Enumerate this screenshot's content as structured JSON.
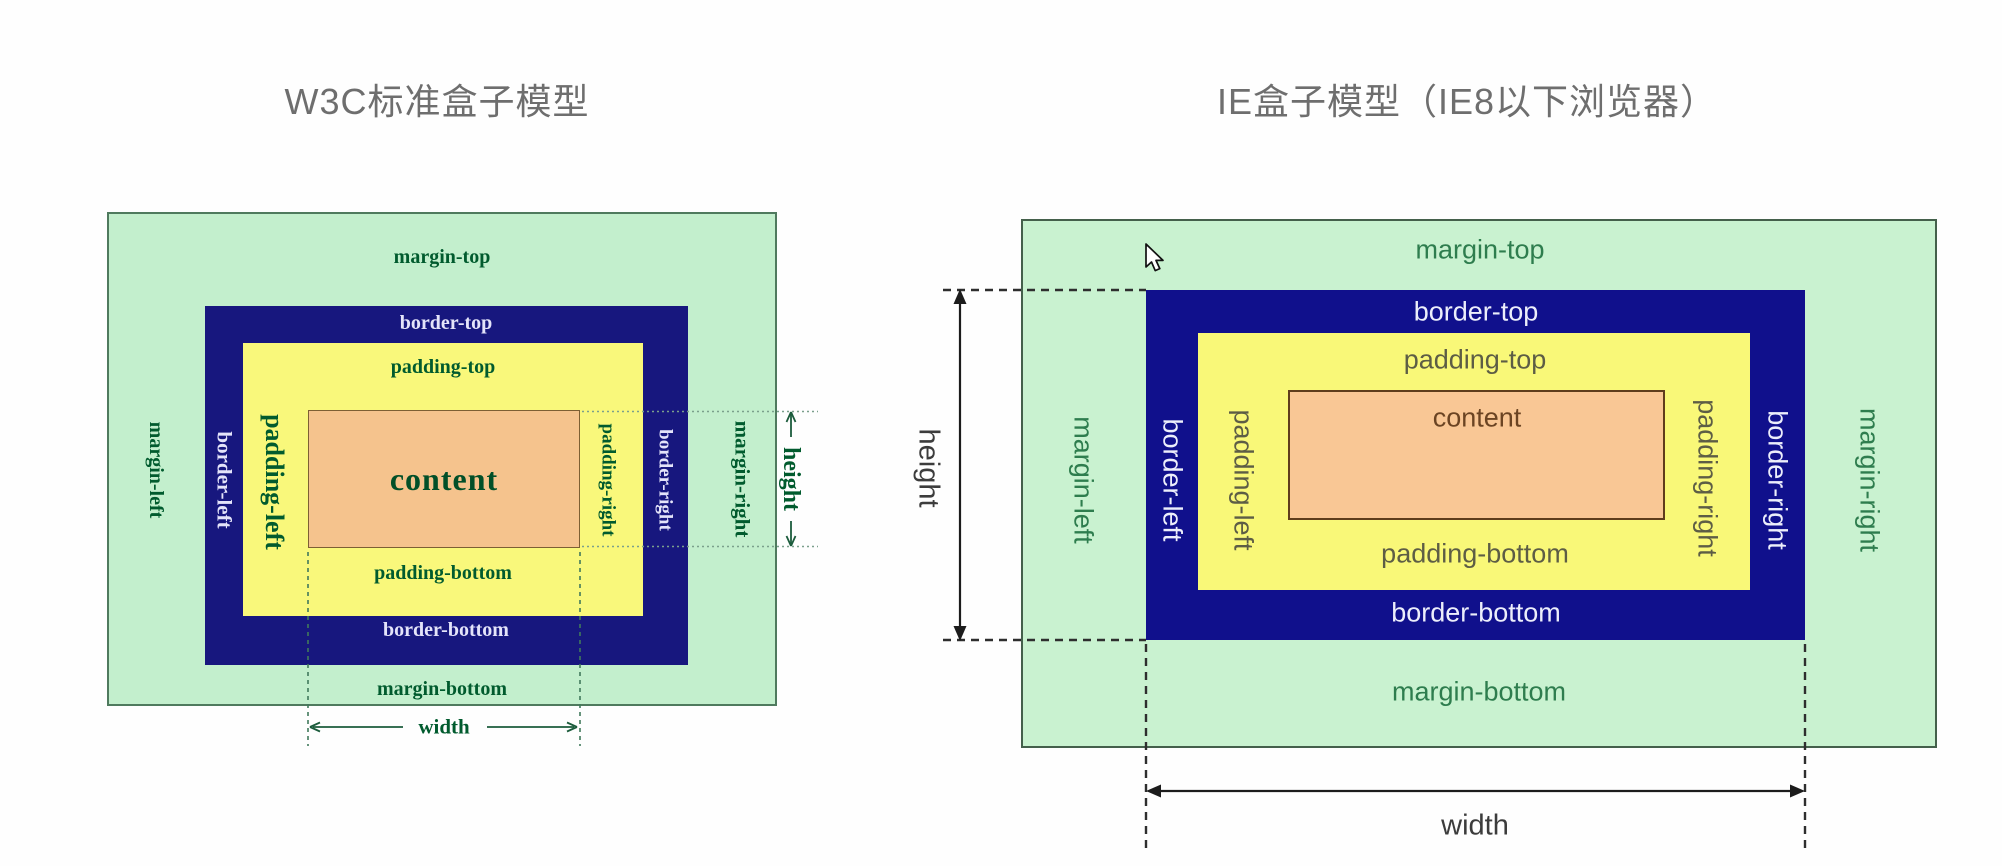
{
  "w3c": {
    "title": "W3C标准盒子模型",
    "labels": {
      "margin_top": "margin-top",
      "border_top": "border-top",
      "padding_top": "padding-top",
      "content": "content",
      "padding_bottom": "padding-bottom",
      "border_bottom": "border-bottom",
      "margin_bottom": "margin-bottom",
      "margin_left": "margin-left",
      "border_left": "border-left",
      "padding_left": "padding-left",
      "padding_right": "padding-right",
      "border_right": "border-right",
      "margin_right": "margin-right",
      "width": "width",
      "height": "height"
    }
  },
  "ie": {
    "title": "IE盒子模型（IE8以下浏览器）",
    "labels": {
      "margin_top": "margin-top",
      "border_top": "border-top",
      "padding_top": "padding-top",
      "content": "content",
      "padding_bottom": "padding-bottom",
      "border_bottom": "border-bottom",
      "margin_bottom": "margin-bottom",
      "margin_left": "margin-left",
      "border_left": "border-left",
      "padding_left": "padding-left",
      "padding_right": "padding-right",
      "border_right": "border-right",
      "margin_right": "margin-right",
      "width": "width",
      "height": "height"
    }
  },
  "colors": {
    "title_gray": "#6e6e6e",
    "w3c_margin_green": "#c3efcd",
    "w3c_border_navy": "#17177e",
    "w3c_padding_yellow": "#f9f87b",
    "w3c_content_orange": "#f5c38d",
    "w3c_label_green": "#015b2e",
    "w3c_label_on_navy": "#e4e4fa",
    "ie_margin_green": "#c9f2d0",
    "ie_border_navy": "#10108c",
    "ie_padding_yellow": "#f9f878",
    "ie_content_orange": "#f9c795",
    "ie_margin_label": "#2e7d4e",
    "ie_padding_label": "#5d5d45",
    "ie_content_label": "#6b4423",
    "measure_text_gray": "#3c3c3c"
  }
}
